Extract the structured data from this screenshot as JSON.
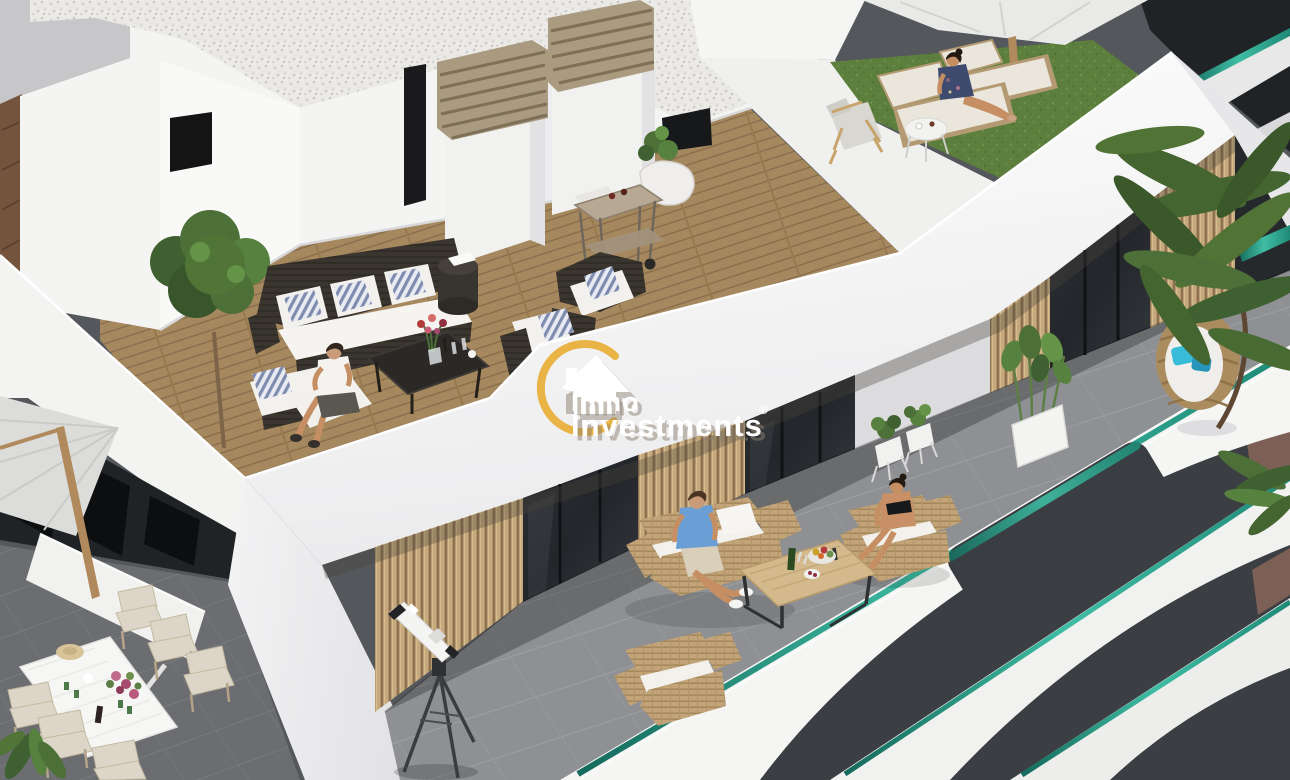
{
  "watermark": {
    "brand_line1": "Inmo",
    "brand_line2": "Investments",
    "registered_mark": "®"
  },
  "scene": {
    "type": "3d-architectural-render",
    "subject": "Aerial view of a modern white penthouse building with rooftop solarium, wooden deck terrace, lower tiled terrace with rattan furniture, dining terrace, palm trees and residents relaxing"
  },
  "colors": {
    "brand_yellow": "#e9b445",
    "watermark_text": "#ffffff",
    "white_wall": "#f6f6f5",
    "teal_glass": "#2e9e8a",
    "wood_deck": "#a6885f",
    "slat_wood": "#c6a97c",
    "terrace_tile": "#8e9093",
    "dining_tile": "#6b6d70",
    "grass_green": "#5d7f3e",
    "rattan_light": "#c2a478",
    "rattan_dark": "#3a352f",
    "dark_facade": "#24272a",
    "brown_wall": "#7d6055",
    "gravel_roof": "#eceae7"
  }
}
